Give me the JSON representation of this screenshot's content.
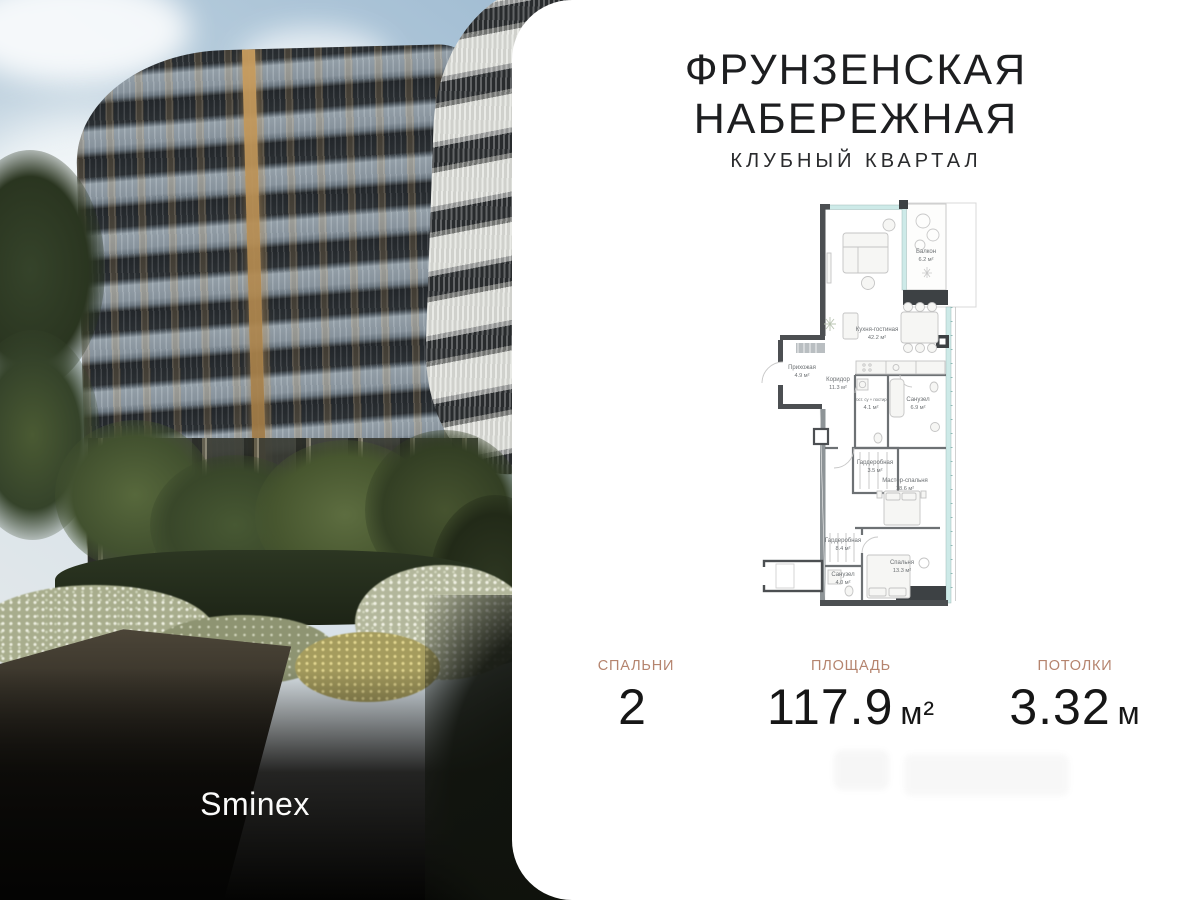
{
  "header": {
    "title_line1": "ФРУНЗЕНСКАЯ",
    "title_line2": "НАБЕРЕЖНАЯ",
    "subtitle": "КЛУБНЫЙ КВАРТАЛ"
  },
  "photo": {
    "brand_logo": "Sminex"
  },
  "floor_plan": {
    "rooms": [
      {
        "name": "Балкон",
        "area": "6.2 м²"
      },
      {
        "name": "Кухня-гостиная",
        "area": "42.2 м²"
      },
      {
        "name": "Прихожая",
        "area": "4.9 м²"
      },
      {
        "name": "Коридор",
        "area": "11.3 м²"
      },
      {
        "name": "Гост. су + постир.",
        "area": "4.1 м²"
      },
      {
        "name": "Санузел",
        "area": "6.9 м²"
      },
      {
        "name": "Гардеробная",
        "area": "3.5 м²"
      },
      {
        "name": "Мастер-спальня",
        "area": "18.6 м²"
      },
      {
        "name": "Гардеробная",
        "area": "8.4 м²"
      },
      {
        "name": "Санузел",
        "area": "4.0 м²"
      },
      {
        "name": "Спальня",
        "area": "13.3 м²"
      }
    ]
  },
  "stats": [
    {
      "label": "СПАЛЬНИ",
      "value": "2",
      "unit": ""
    },
    {
      "label": "ПЛОЩАДЬ",
      "value": "117.9",
      "unit": "м²"
    },
    {
      "label": "ПОТОЛКИ",
      "value": "3.32",
      "unit": "м"
    }
  ],
  "colors": {
    "accent": "#b5846e",
    "title": "#1d1e20",
    "value": "#161616",
    "plan_wall": "#4c4f52",
    "plan_glass": "#cdeae8",
    "plan_dark": "#3d4144"
  }
}
